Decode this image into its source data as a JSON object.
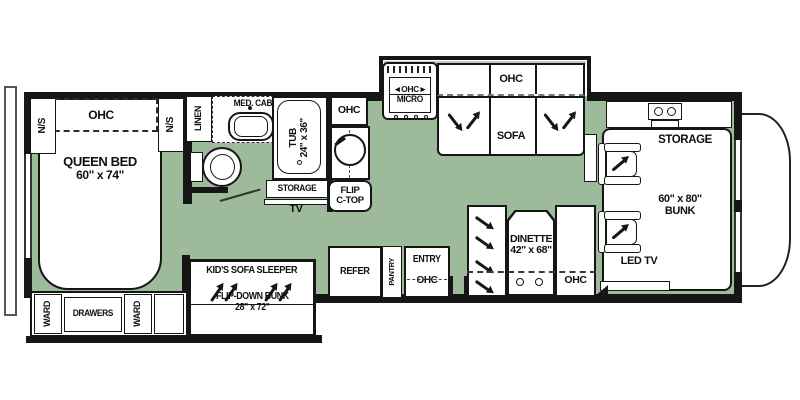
{
  "colors": {
    "floor": "#9dbb9b",
    "wall": "#161616"
  },
  "bedroom": {
    "ns_left": "N/S",
    "ohc": "OHC",
    "ns_right": "N/S",
    "bed_line1": "QUEEN BED",
    "bed_line2": "60\" x 74\"",
    "ward_left": "WARD",
    "drawers": "DRAWERS",
    "ward_right": "WARD"
  },
  "bathroom": {
    "linen": "LINEN",
    "med_cab": "MED. CAB",
    "tub_line1": "TUB",
    "tub_line2": "24\" x 36\"",
    "storage": "STORAGE",
    "tv": "TV"
  },
  "kitchen": {
    "ohc": "OHC",
    "flip_line1": "FLIP",
    "flip_line2": "C-TOP",
    "range_ohc": "◄OHC►",
    "range_micro": "MICRO"
  },
  "living": {
    "sofa_ohc": "OHC",
    "sofa": "SOFA"
  },
  "kid_sofa": {
    "title": "KID'S SOFA SLEEPER",
    "bunk_line1": "FLIP-DOWN BUNK",
    "bunk_line2": "28\" x 72\""
  },
  "galley": {
    "refer": "REFER",
    "pantry": "PANTRY",
    "entry": "ENTRY",
    "entry_ohc": "OHC"
  },
  "dinette": {
    "name": "DINETTE",
    "size": "42\" x 68\"",
    "ohc": "OHC"
  },
  "front": {
    "storage": "STORAGE",
    "bunk_size": "60\" x 80\"",
    "bunk": "BUNK",
    "led_tv": "LED TV"
  }
}
